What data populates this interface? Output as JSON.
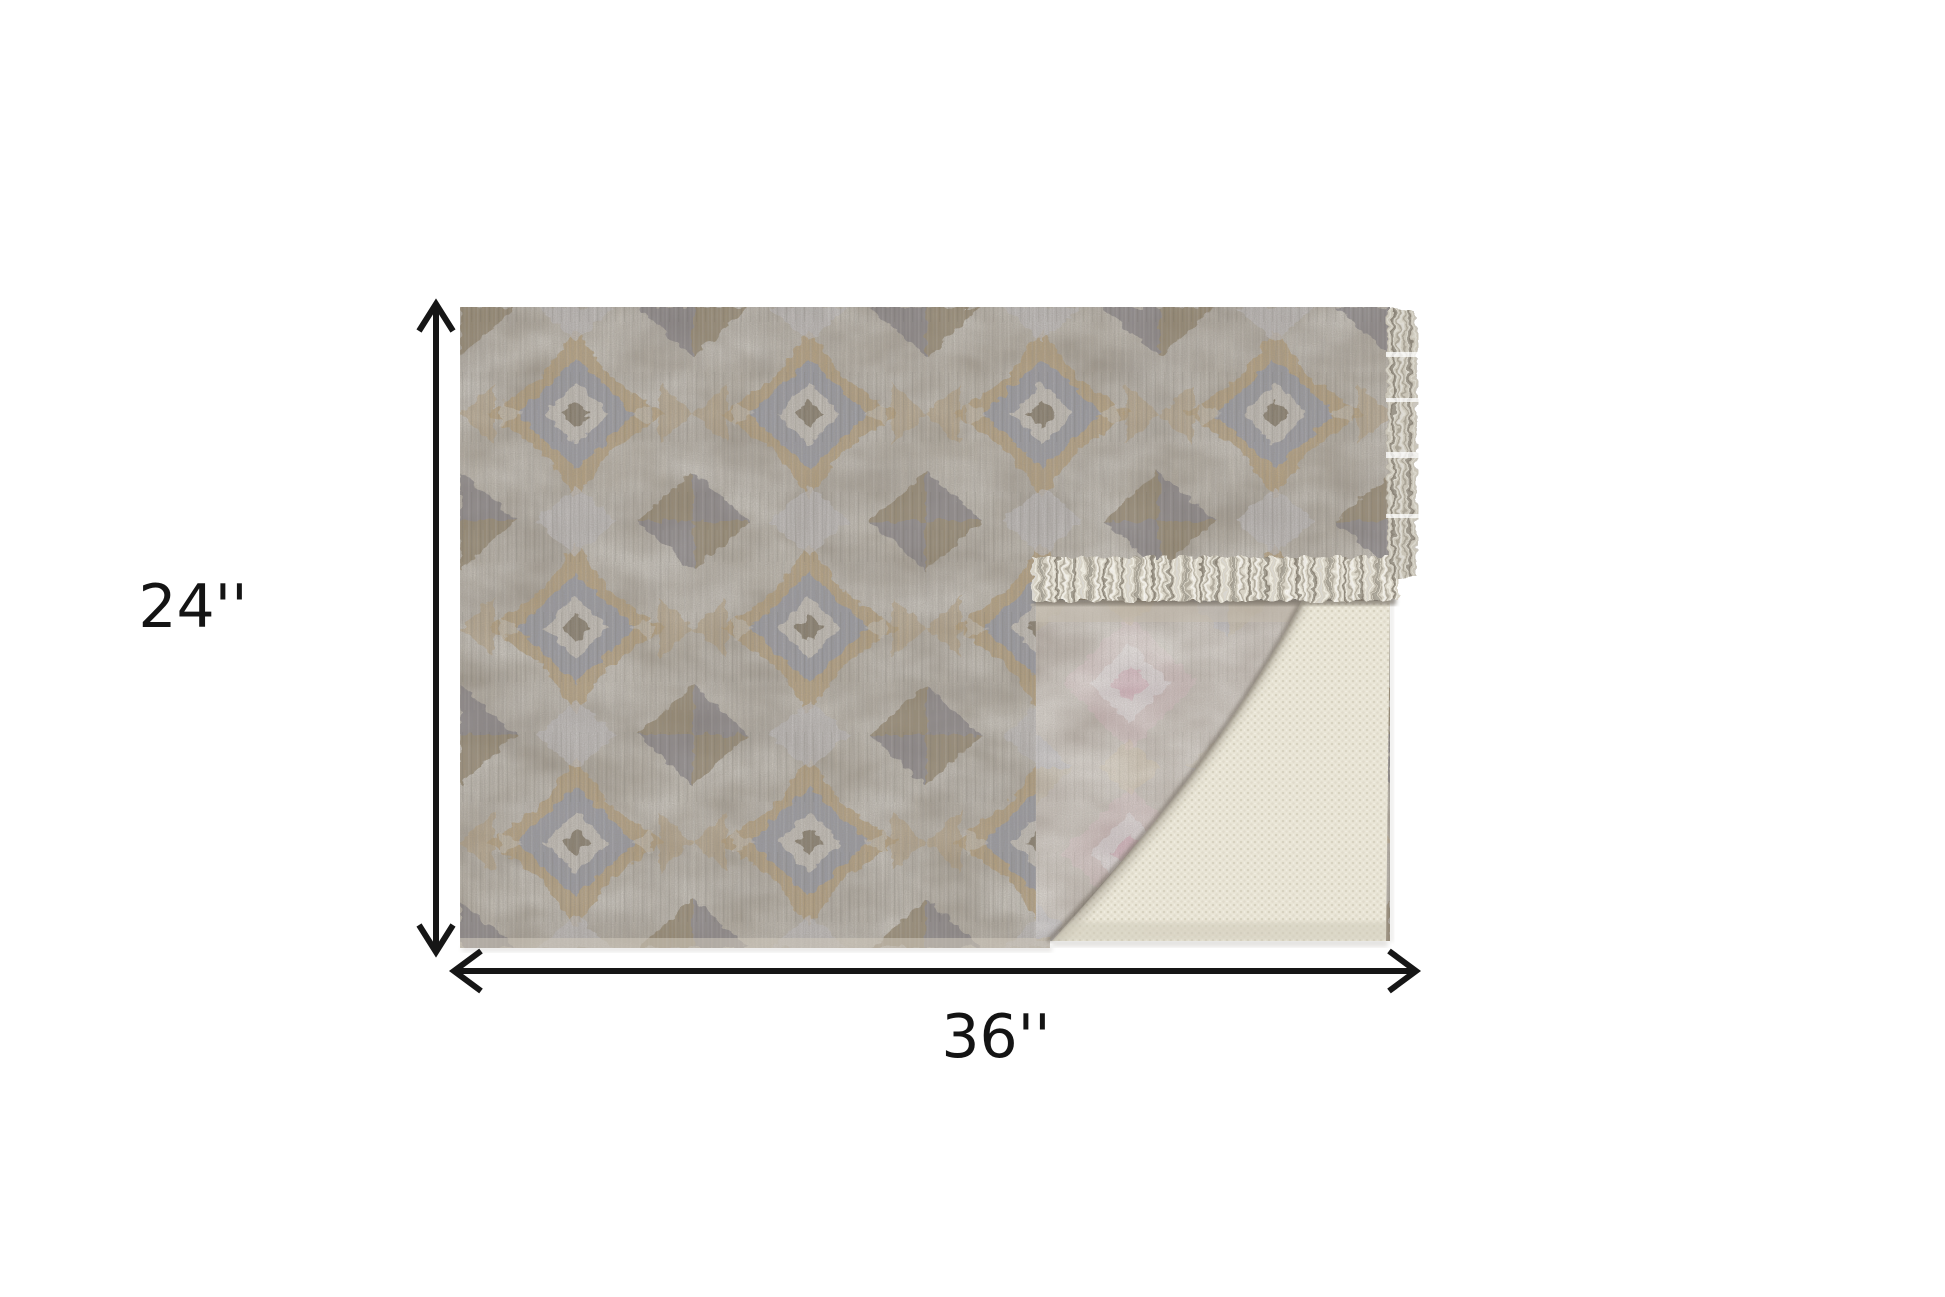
{
  "diagram": {
    "height_label": "24''",
    "width_label": "36''",
    "arrow_color": "#161616",
    "label_color": "#141414",
    "background_color": "#ffffff",
    "rug": {
      "front_base_color": "#a59c8e",
      "front_accent_tan": "#b79e74",
      "front_accent_blue_gray": "#959aab",
      "front_accent_brown": "#87765a",
      "front_accent_light_gray": "#c6c4c6",
      "back_base_color": "#b4aba3",
      "back_accent_pink": "#c6abb1",
      "pad_color": "#e9e5d6",
      "fringe_color": "#d8d3c6"
    }
  }
}
